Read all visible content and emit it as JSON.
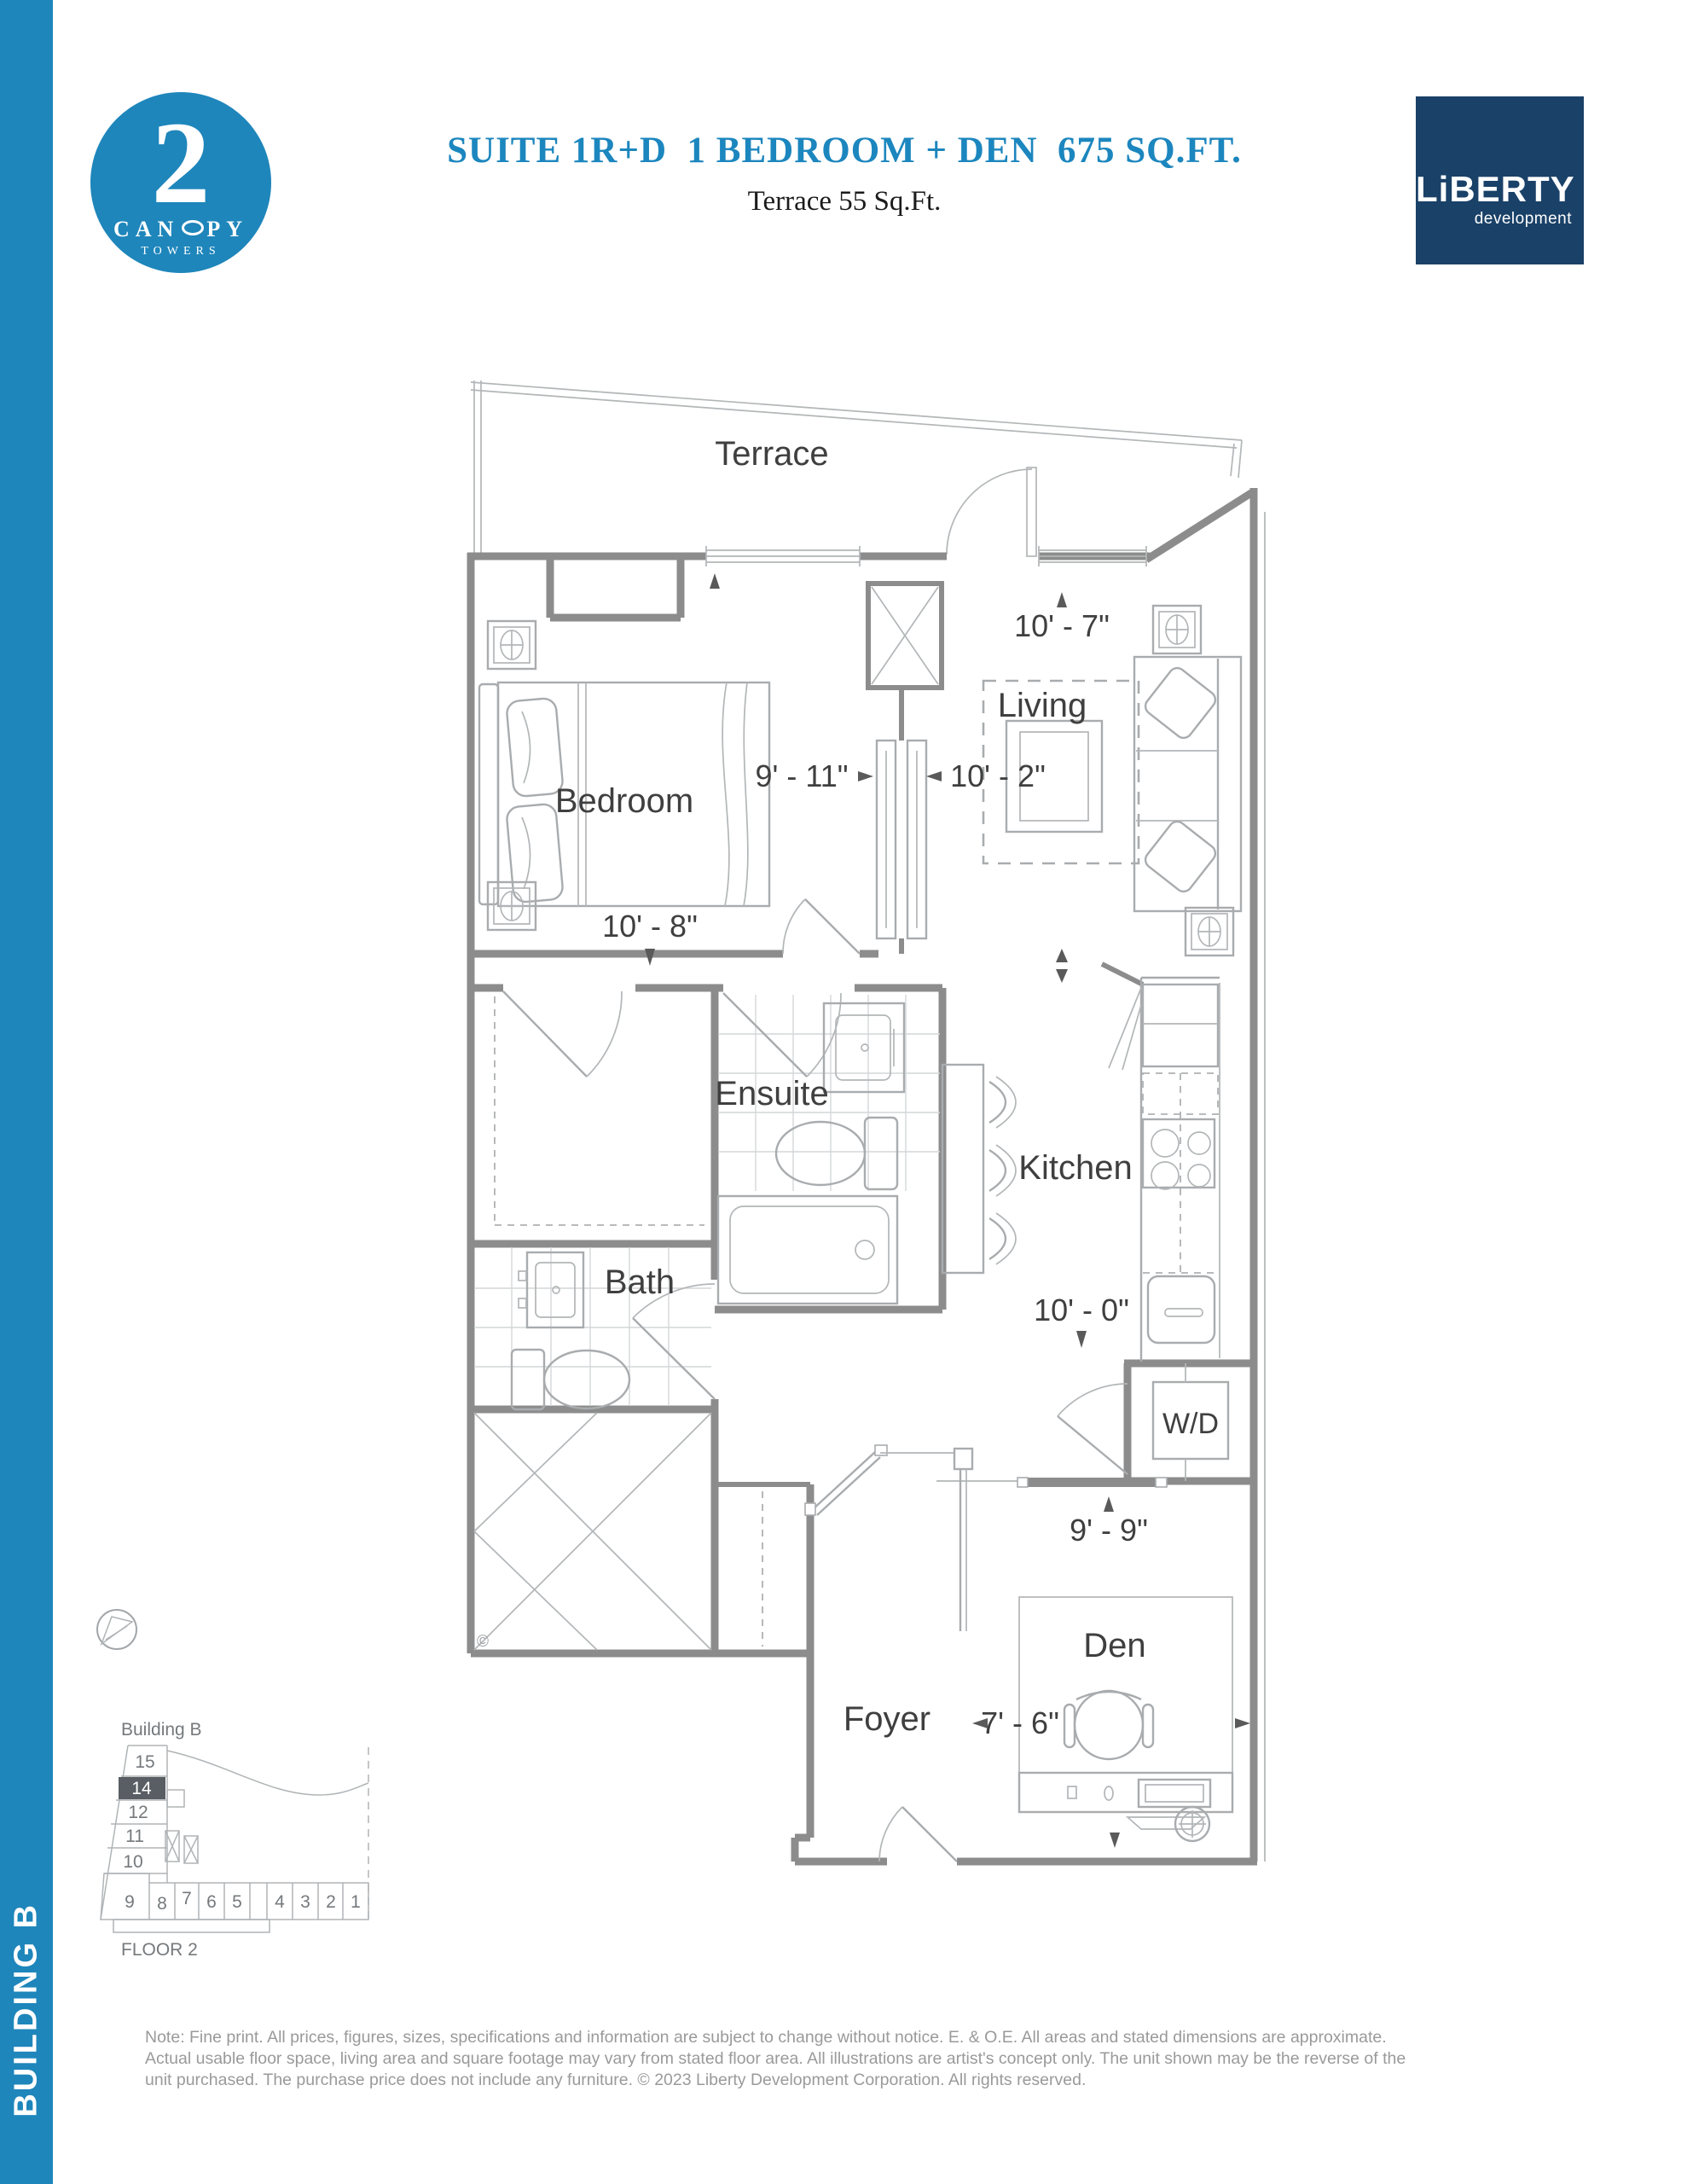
{
  "sidebar": {
    "label": "BUILDING B"
  },
  "logo": {
    "number": "2",
    "name_pre": "CAN",
    "name_post": "PY",
    "towers": "TOWERS"
  },
  "header": {
    "title": "SUITE 1R+D  1 BEDROOM + DEN  675 SQ.FT.",
    "subtitle": "Terrace 55 Sq.Ft."
  },
  "brand": {
    "name": "LiBERTY",
    "tagline": "development"
  },
  "plan": {
    "rooms": {
      "terrace": "Terrace",
      "living": "Living",
      "bedroom": "Bedroom",
      "ensuite": "Ensuite",
      "kitchen": "Kitchen",
      "bath": "Bath",
      "wd": "W/D",
      "foyer": "Foyer",
      "den": "Den"
    },
    "dimensions": {
      "living_width": "10' - 7\"",
      "bedroom_width": "9' - 11\"",
      "living_depth": "10' - 2\"",
      "bedroom_depth": "10' - 8\"",
      "kitchen_length": "10' - 0\"",
      "den_width": "9' - 9\"",
      "den_depth": "7' - 6\""
    },
    "copyright_mark": "©"
  },
  "keyplan": {
    "building": "Building B",
    "floor": "FLOOR 2",
    "stack_units": [
      "15",
      "14",
      "12",
      "11",
      "10"
    ],
    "row_units": [
      "9",
      "8",
      "7",
      "6",
      "5",
      "4",
      "3",
      "2",
      "1"
    ],
    "highlighted_unit": "14"
  },
  "note": {
    "line1": "Note: Fine print. All prices, figures, sizes, specifications and information are subject to change without notice. E. & O.E. All areas and stated dimensions are approximate.",
    "line2": "Actual usable floor space, living area and square footage may vary from stated floor area. All illustrations are artist's concept only. The unit shown may be the reverse of the",
    "line3": "unit purchased. The purchase price does not include any furniture. © 2023 Liberty Development Corporation. All rights reserved."
  },
  "colors": {
    "accent": "#1E86BB",
    "navy": "#1A4168",
    "wall": "#8C8C8C",
    "label": "#3F3F3F",
    "note": "#9A9A9A"
  }
}
